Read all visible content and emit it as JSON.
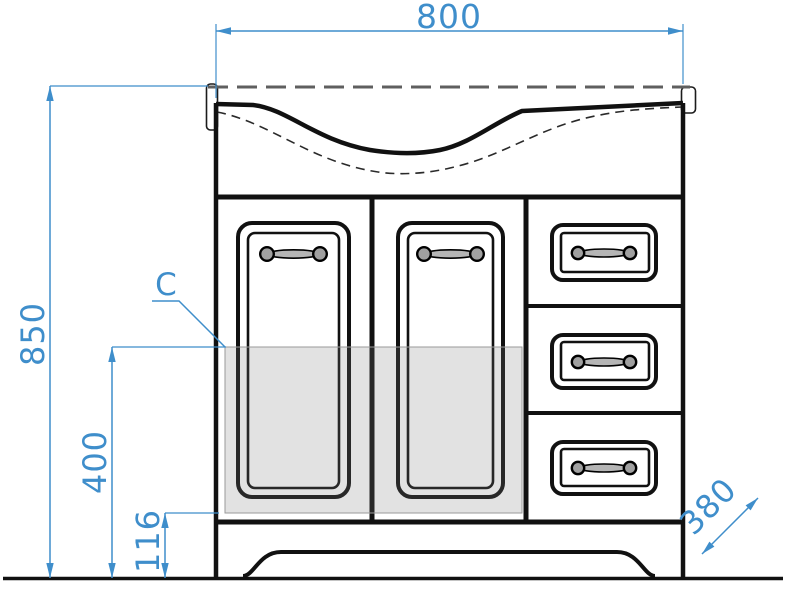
{
  "drawing": {
    "kind": "bathroom-vanity-front-elevation",
    "dimension_labels": {
      "width": "800",
      "height": "850",
      "zone_height": "400",
      "plinth_height": "116",
      "depth": "380"
    },
    "annotations": {
      "zone_label": "C"
    },
    "components": {
      "doors": 2,
      "drawers": 3
    },
    "colors": {
      "dimension_blue": "#3f8ecb",
      "outline_black": "#111111",
      "hidden_line_gray": "#5f5f5f",
      "zone_shade_gray": "#d8d8d8",
      "handle_gray": "#a8a8a8",
      "background": "#ffffff"
    }
  }
}
